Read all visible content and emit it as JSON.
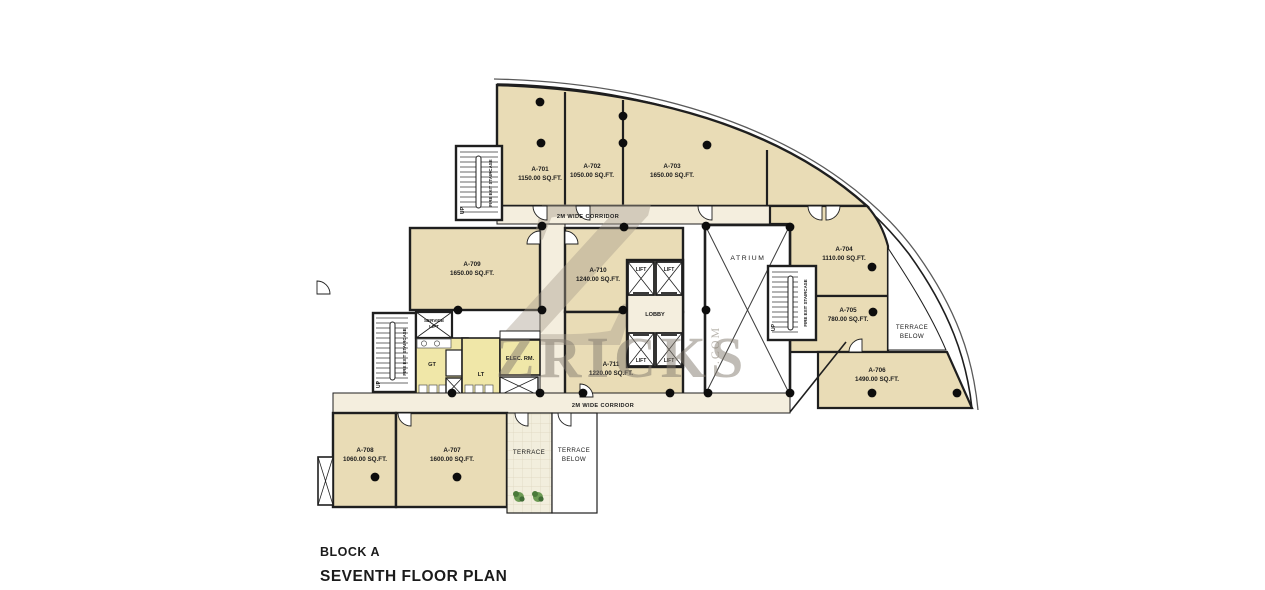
{
  "title": {
    "block": "BLOCK A",
    "plan": "SEVENTH FLOOR PLAN"
  },
  "watermark": {
    "logo": "Z",
    "name": "ZRICKS",
    "suffix": ".COM"
  },
  "labels": {
    "corridor": "2M WIDE CORRIDOR",
    "lobby": "LOBBY",
    "atrium": "ATRIUM",
    "lift": "LIFT",
    "service_1": "SERVICE",
    "service_2": "LIFT",
    "elec_rm": "ELEC. RM.",
    "gt": "GT",
    "lt": "LT",
    "terrace": "TERRACE",
    "below": "BELOW",
    "up": "UP",
    "fire_exit": "FIRE EXIT STAIRCASE"
  },
  "rooms": {
    "a701": {
      "name": "A-701",
      "area": "1150.00 SQ.FT."
    },
    "a702": {
      "name": "A-702",
      "area": "1050.00 SQ.FT."
    },
    "a703": {
      "name": "A-703",
      "area": "1650.00 SQ.FT."
    },
    "a704": {
      "name": "A-704",
      "area": "1110.00 SQ.FT."
    },
    "a705": {
      "name": "A-705",
      "area": "780.00 SQ.FT."
    },
    "a706": {
      "name": "A-706",
      "area": "1490.00 SQ.FT."
    },
    "a707": {
      "name": "A-707",
      "area": "1600.00 SQ.FT."
    },
    "a708": {
      "name": "A-708",
      "area": "1060.00 SQ.FT."
    },
    "a709": {
      "name": "A-709",
      "area": "1650.00 SQ.FT."
    },
    "a710": {
      "name": "A-710",
      "area": "1240.00 SQ.FT."
    },
    "a711": {
      "name": "A-711",
      "area": "1220.00 SQ.FT."
    }
  },
  "colors": {
    "room_fill": "#e9dcb6",
    "corridor_fill": "#f4eede",
    "toilet_fill": "#f0e7a8",
    "wall": "#1f1f1f",
    "watermark": "#837b6f"
  }
}
